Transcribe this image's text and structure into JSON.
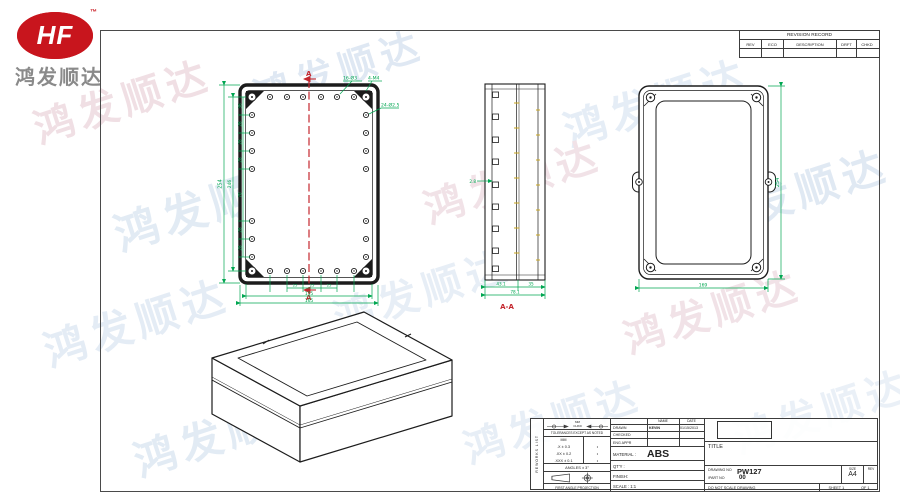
{
  "branding": {
    "logo_text": "HF",
    "trademark": "™",
    "company_name": "鸿发顺达",
    "watermark_text": "鸿发顺达"
  },
  "revision_table": {
    "title": "REVISION RECORD",
    "col_rev": "REV",
    "col_eco": "ECO",
    "col_description": "DESCRIPTION",
    "col_drft": "DRFT",
    "col_chkd": "CHKD"
  },
  "front_view": {
    "hole_note_1": "16-Ø3",
    "hole_note_2": "4-M4",
    "hole_note_3": "24-Ø2.5",
    "dim_outer_height": "254",
    "dim_inner_height": "246",
    "seg_1": "36",
    "seg_2": "28",
    "seg_3": "28",
    "seg_4": "28",
    "seg_5": "70",
    "seg_6": "28",
    "seg_7": "28",
    "pitch_1": "25",
    "pitch_2": "25",
    "pitch_3": "25",
    "dim_inner_width": "155",
    "dim_outer_width": "165",
    "section_marker": "A"
  },
  "section_view": {
    "label": "A-A",
    "dim_wall": "2.8",
    "dim_depth_left": "43.1",
    "dim_depth_right": "35",
    "dim_depth_total": "78.1"
  },
  "back_view": {
    "dim_height": "254",
    "dim_width": "169"
  },
  "title_block": {
    "side_label": "REWORKS LIST",
    "symbol_mm": "MM",
    "symbol_chkd": "CHKD",
    "tolerances_note": "TOLERANCES EXCEPT AS NOTED",
    "tol_unit": "MM",
    "tol_row_1": ".X ± 0.3",
    "tol_row_2": ".XX ± 0.2",
    "tol_row_3": ".XXX ± 0.1",
    "tol_mark": "•",
    "angles": "ANGLES ± 3°",
    "projection_label": "FIRST ANGLE PROJECTION",
    "name_header": "NAME",
    "date_header": "DATE",
    "drawn_label": "DRAWN",
    "drawn_name": "KEVIN",
    "drawn_date": "01/15/2013",
    "checked_label": "CHECKED",
    "eng_appr_label": "ENG APPR",
    "material_label": "MATERIAL :",
    "material_value": "ABS",
    "qty_label": "QT'Y :",
    "finish_label": "FINISH:",
    "scale_label": "SCALE : 1:1",
    "title_label": "TITLE",
    "drawing_no_label": "DRAWING NO",
    "drawing_no_value": "PW127",
    "part_no_label": "/PART  NO",
    "part_no_value": "00",
    "size_label": "SIZE",
    "size_value": "A4",
    "rev_label": "REV",
    "do_not_scale": "DO NOT SCALE DRAWING",
    "sheet_label": "SHEET 1",
    "sheet_of": "OF 1"
  },
  "colors": {
    "dimension_green": "#00a651",
    "section_red": "#c4272e",
    "logo_red": "#c8151d",
    "line_dark": "#1c1c1c"
  }
}
